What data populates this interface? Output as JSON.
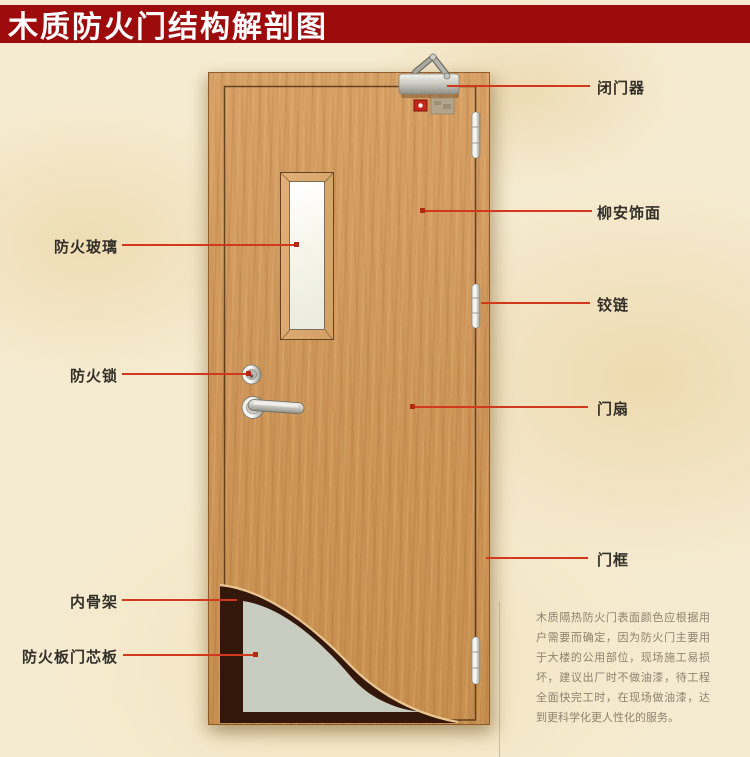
{
  "title": "木质防火门结构解剖图",
  "labels": {
    "door_closer": "闭门器",
    "lauan_veneer": "柳安饰面",
    "hinge": "铰链",
    "door_leaf": "门扇",
    "door_frame": "门框",
    "fire_glass": "防火玻璃",
    "fire_lock": "防火锁",
    "inner_frame": "内骨架",
    "fire_board_core": "防火板门芯板"
  },
  "description": "木质隔热防火门表面颜色应根据用户需要而确定，因为防火门主要用于大楼的公用部位，现场施工易损坏，建议出厂时不做油漆，待工程全面快完工时，在现场做油漆，达到更科学化更人性化的服务。",
  "colors": {
    "banner": "#9d0b0c",
    "callout_line": "#d2391c",
    "door_wood": "#d09a60",
    "core_board": "#c9ccc1",
    "inner_frame_dark": "#33170a",
    "background": "#f5ebd0",
    "title_text": "#ffffff",
    "label_text": "#33302a",
    "description_text": "#8e8271"
  }
}
